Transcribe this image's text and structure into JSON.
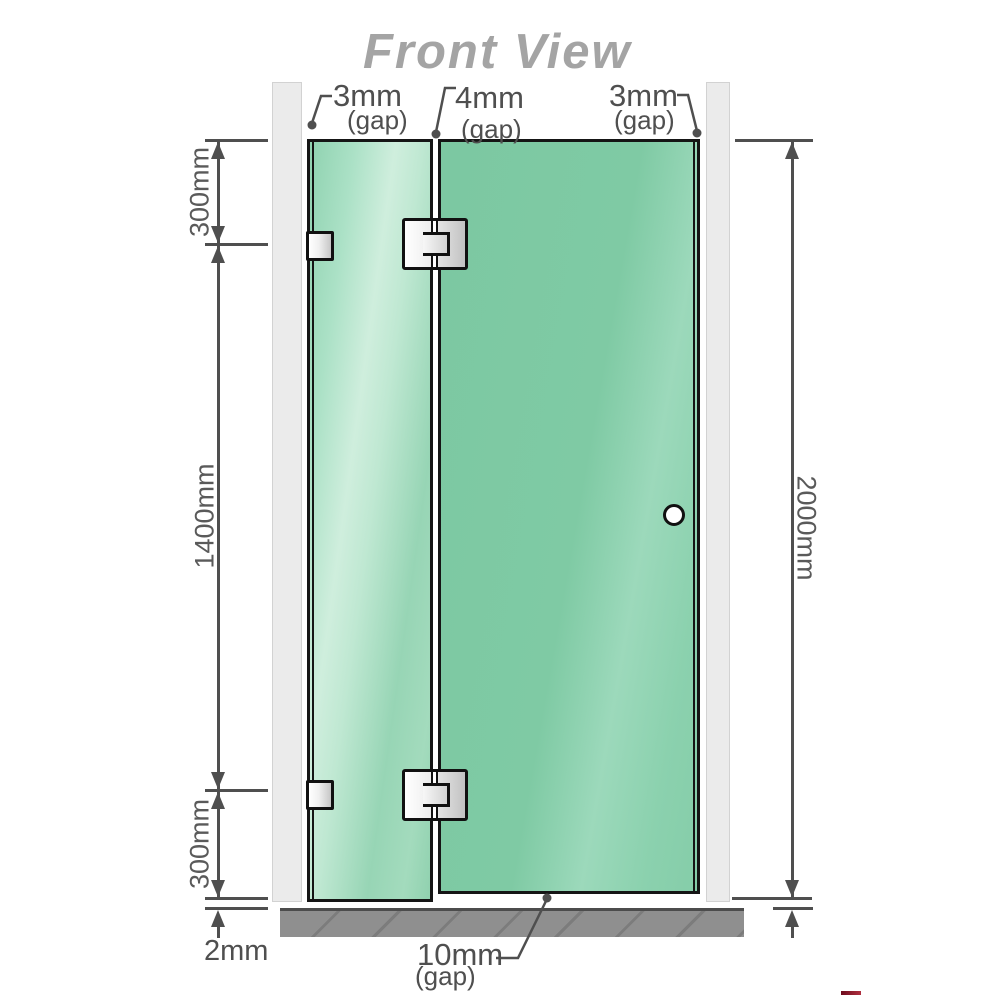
{
  "title": "Front View",
  "top_gaps": {
    "left": {
      "value": "3mm",
      "note": "(gap)"
    },
    "center": {
      "value": "4mm",
      "note": "(gap)"
    },
    "right": {
      "value": "3mm",
      "note": "(gap)"
    }
  },
  "left_dimensions": {
    "top": "300mm",
    "middle": "1400mm",
    "bottom": "300mm",
    "floor_gap": "2mm"
  },
  "right_dimension": {
    "total_height": "2000mm"
  },
  "bottom_gap": {
    "value": "10mm",
    "note": "(gap)"
  },
  "colors": {
    "glass_fixed_panel": "#abe1c6",
    "glass_door_panel": "#7fc9a3",
    "wall": "#ebebeb",
    "floor": "#8f8f8f",
    "dimension_lines": "#4f4f4f",
    "title_text": "#a4a4a4",
    "hardware_fill": "#e8e8e8"
  }
}
